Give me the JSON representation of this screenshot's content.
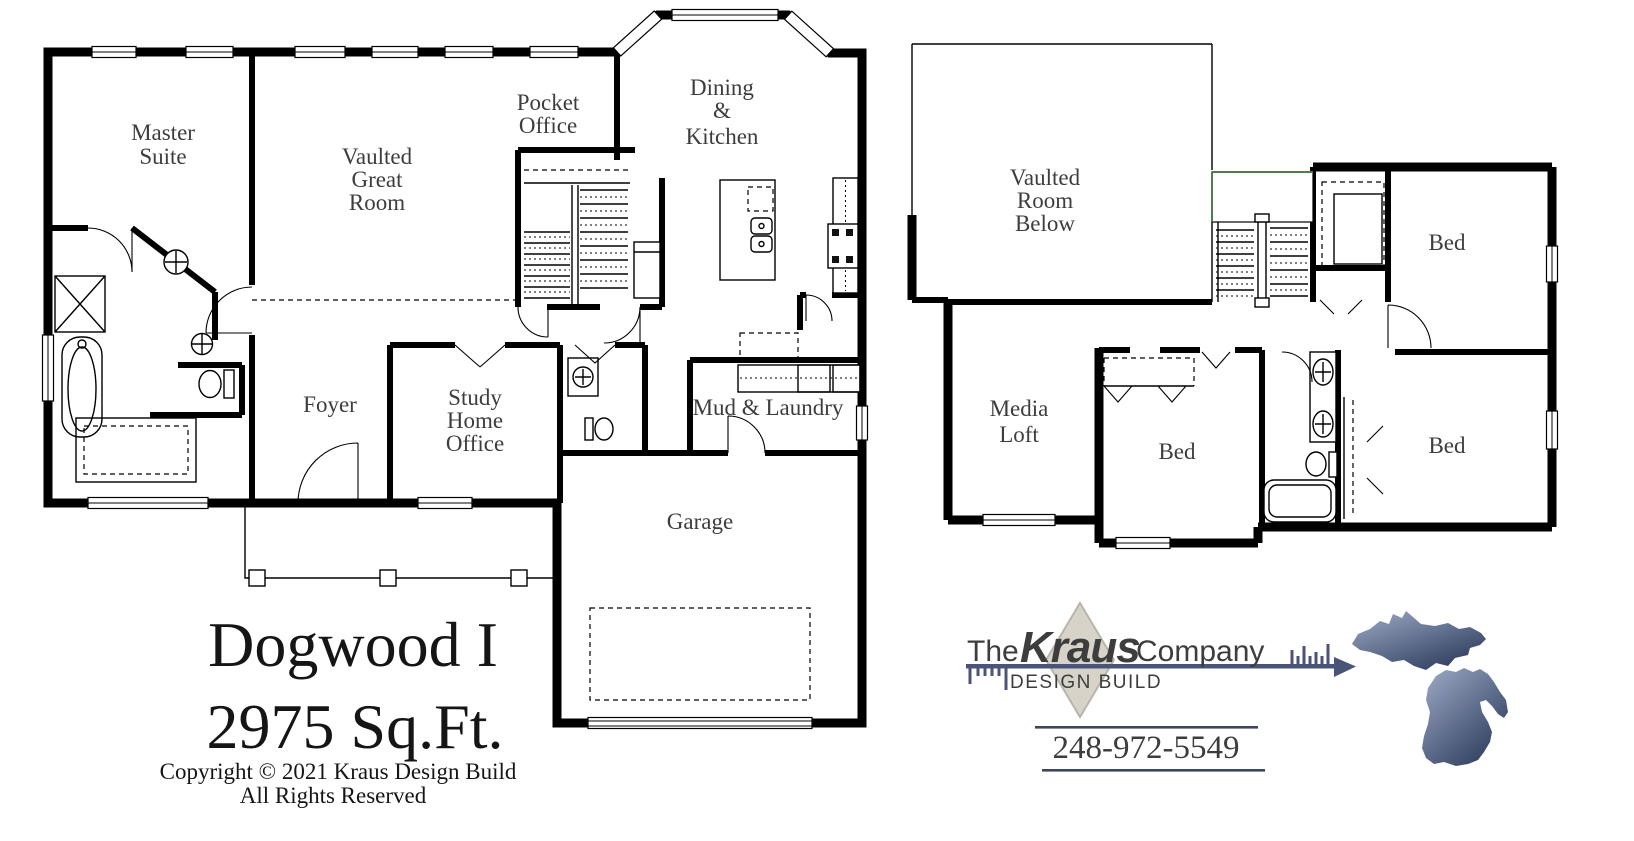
{
  "first_floor": {
    "rooms": {
      "master_suite": [
        "Master",
        "Suite"
      ],
      "great_room": [
        "Vaulted",
        "Great",
        "Room"
      ],
      "pocket_office": [
        "Pocket",
        "Office"
      ],
      "dining_kitchen": [
        "Dining",
        "&",
        "Kitchen"
      ],
      "foyer": [
        "Foyer"
      ],
      "study": [
        "Study",
        "Home",
        "Office"
      ],
      "mud_laundry": [
        "Mud & Laundry"
      ],
      "garage": [
        "Garage"
      ]
    }
  },
  "second_floor": {
    "rooms": {
      "vaulted_below": [
        "Vaulted",
        "Room",
        "Below"
      ],
      "bed_upper_right": [
        "Bed"
      ],
      "media_loft": [
        "Media",
        "Loft"
      ],
      "bed_center": [
        "Bed"
      ],
      "bed_lower_right": [
        "Bed"
      ]
    }
  },
  "title_block": {
    "plan_name": "Dogwood I",
    "area": "2975 Sq.Ft.",
    "copyright": "Copyright © 2021 Kraus Design Build",
    "rights": "All Rights Reserved"
  },
  "logo": {
    "prefix": "The",
    "brand": "Kraus",
    "suffix": "Company",
    "tagline": "DESIGN BUILD",
    "phone": "248-972-5549"
  },
  "colors": {
    "walls": "#000000",
    "label_text": "#3d3d3d",
    "brand_green": "#2e5c30",
    "logo_text": "#23232a",
    "tagline_gray": "#5a6378",
    "arrow_navy": "#4a5378",
    "diamond_fill": "#d7d3c8",
    "diamond_edge": "#b9b5aa",
    "phone_navy": "#303a55",
    "michigan_light": "#9fadc8",
    "michigan_dark": "#2c3a5c",
    "stair_rail_green": "#4d7d4d"
  }
}
